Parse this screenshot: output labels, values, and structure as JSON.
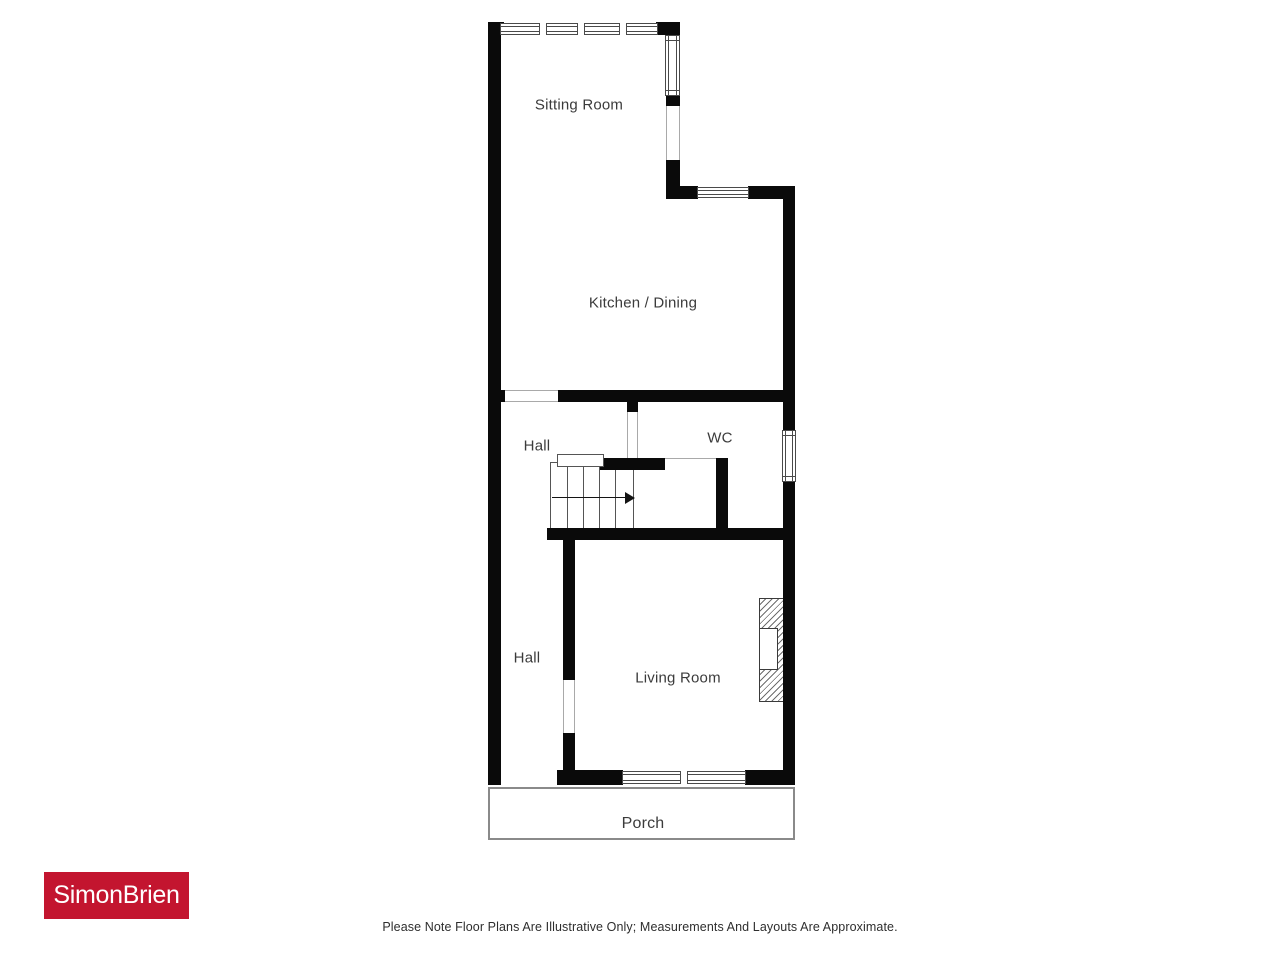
{
  "floorplan": {
    "rooms": {
      "sitting_room": "Sitting Room",
      "kitchen_dining": "Kitchen / Dining",
      "hall_upper": "Hall",
      "wc": "WC",
      "hall_lower": "Hall",
      "living_room": "Living Room",
      "porch": "Porch"
    },
    "features": {
      "stairs": "staircase with direction arrow pointing right",
      "fireplace": "hatched chimney breast on living room east wall",
      "windows": "north wall (4-pane), sitting room east, kitchen north, wc east, living room south (2-pane)"
    }
  },
  "branding": {
    "agency": "SimonBrien",
    "logo_bg": "#c3152f",
    "logo_text_color": "#ffffff"
  },
  "disclaimer": "Please Note Floor Plans Are Illustrative Only; Measurements And Layouts Are Approximate.",
  "colors": {
    "wall": "#0a0a0a",
    "label_text": "#3b3b3b",
    "porch_outline": "#8a8a8a"
  }
}
